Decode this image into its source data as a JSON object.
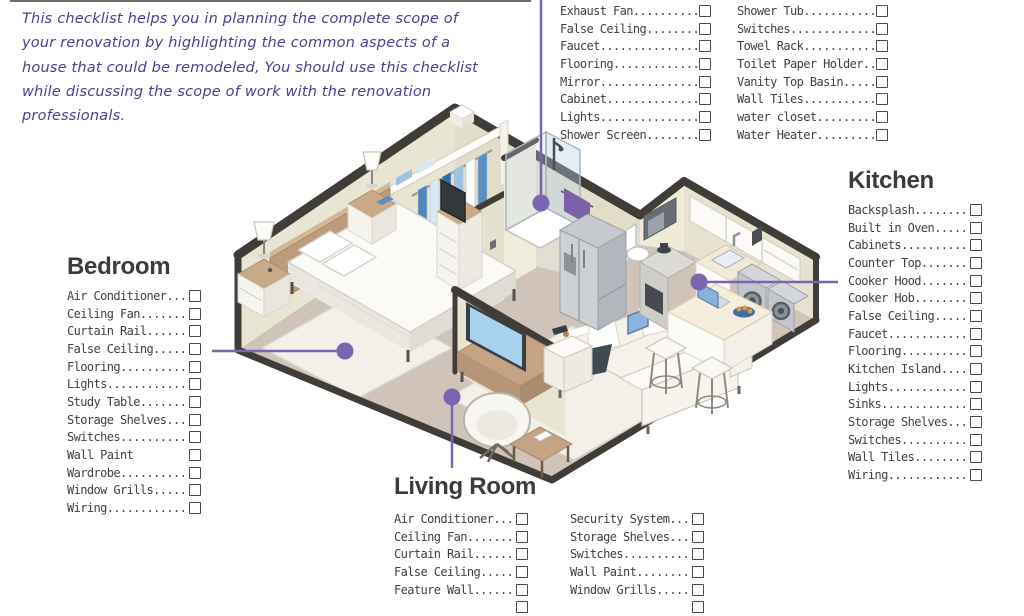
{
  "intro": {
    "lines": [
      "This checklist helps you in planning the complete scope of",
      "your renovation by highlighting the common aspects of a",
      "house that could be remodeled, You should use this checklist",
      "while discussing the scope of work with the renovation",
      "professionals."
    ]
  },
  "bathroom_list": {
    "col1": [
      "Exhaust Fan..........",
      "False Ceiling........",
      "Faucet...............",
      "Flooring.............",
      "Mirror...............",
      "Cabinet..............",
      "Lights...............",
      "Shower Screen........"
    ],
    "col2": [
      "Shower Tub...........",
      "Switches.............",
      "Towel Rack...........",
      "Toilet Paper Holder..",
      "Vanity Top Basin.....",
      "Wall Tiles...........",
      "water closet.........",
      "Water Heater........."
    ]
  },
  "bedroom": {
    "title": "Bedroom",
    "items": [
      "Air Conditioner...",
      "Ceiling Fan.......",
      "Curtain Rail......",
      "False Ceiling.....",
      "Flooring..........",
      "Lights............",
      "Study Table.......",
      "Storage Shelves...",
      "Switches..........",
      "Wall Paint",
      "Wardrobe..........",
      "Window Grills.....",
      "Wiring............"
    ]
  },
  "kitchen": {
    "title": "Kitchen",
    "items": [
      "Backsplash........",
      "Built in Oven.....",
      "Cabinets..........",
      "Counter Top.......",
      "Cooker Hood.......",
      "Cooker Hob........",
      "False Ceiling.....",
      "Faucet............",
      "Flooring..........",
      "Kitchen Island....",
      "Lights............",
      "Sinks.............",
      "Storage Shelves...",
      "Switches..........",
      "Wall Tiles........",
      "Wiring............"
    ]
  },
  "living_room": {
    "title": "Living Room",
    "col1": [
      "Air Conditioner...",
      "Ceiling Fan.......",
      "Curtain Rail......",
      "False Ceiling.....",
      "Feature Wall......",
      ""
    ],
    "col2": [
      "Security System...",
      "Storage Shelves...",
      "Switches..........",
      "Wall Paint........",
      "Window Grills.....",
      ""
    ]
  },
  "colors": {
    "intro_text": "#4b3e94",
    "checklist_text": "#414141",
    "heading_text": "#3b3b3b",
    "leader_purple": "#7a66ae",
    "wall_dark": "#403c37",
    "wall_cream": "#e9e5d3",
    "floor_taupe": "#cfc3ba",
    "towel_purple": "#7c60a9",
    "tv_screen_blue": "#a8d3ef"
  }
}
